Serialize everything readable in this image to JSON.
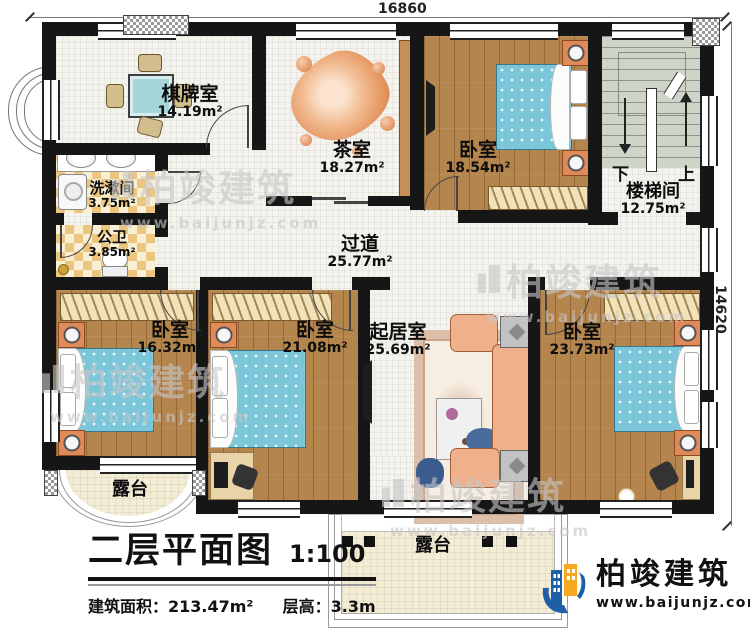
{
  "dimensions": {
    "top": "16860",
    "right": "14620"
  },
  "rooms": {
    "chess": {
      "name": "棋牌室",
      "area": "14.19m²"
    },
    "tea": {
      "name": "茶室",
      "area": "18.27m²"
    },
    "bedroom_top": {
      "name": "卧室",
      "area": "18.54m²"
    },
    "stair": {
      "name": "楼梯间",
      "area": "12.75m²",
      "down": "下",
      "up": "上"
    },
    "wash": {
      "name": "洗漱间",
      "area": "3.75m²"
    },
    "toilet": {
      "name": "公卫",
      "area": "3.85m²"
    },
    "corridor": {
      "name": "过道",
      "area": "25.77m²"
    },
    "bedroom_left": {
      "name": "卧室",
      "area": "16.32m²"
    },
    "bedroom_mid": {
      "name": "卧室",
      "area": "21.08m²"
    },
    "living": {
      "name": "起居室",
      "area": "25.69m²"
    },
    "bedroom_right": {
      "name": "卧室",
      "area": "23.73m²"
    },
    "terrace_left": {
      "name": "露台"
    },
    "terrace_bottom": {
      "name": "露台"
    }
  },
  "titleblock": {
    "title": "二层平面图",
    "scale": "1:100",
    "area_label": "建筑面积：",
    "area_value": "213.47m²",
    "floor_height_label": "层高：",
    "floor_height_value": "3.3m"
  },
  "branding": {
    "company": "柏竣建筑",
    "website": "www.baijunjz.com"
  },
  "watermark": {
    "company": "柏竣建筑",
    "website": "www.baijunjz.com"
  },
  "colors": {
    "wall": "#161616",
    "wood_floor": "#b5854e",
    "tile_floor": "#f4f3ee",
    "checker_floor": "#ecc67f",
    "bed_blue": "#7cc6da",
    "stair_green": "#ced4c7",
    "terrace": "#f4edd5",
    "sofa_salmon": "#efb18c",
    "nightstand_orange": "#e08a5a",
    "logo_blue": "#1f5fa8",
    "logo_orange": "#f6a821",
    "watermark_gray": "#c7c7c7"
  }
}
